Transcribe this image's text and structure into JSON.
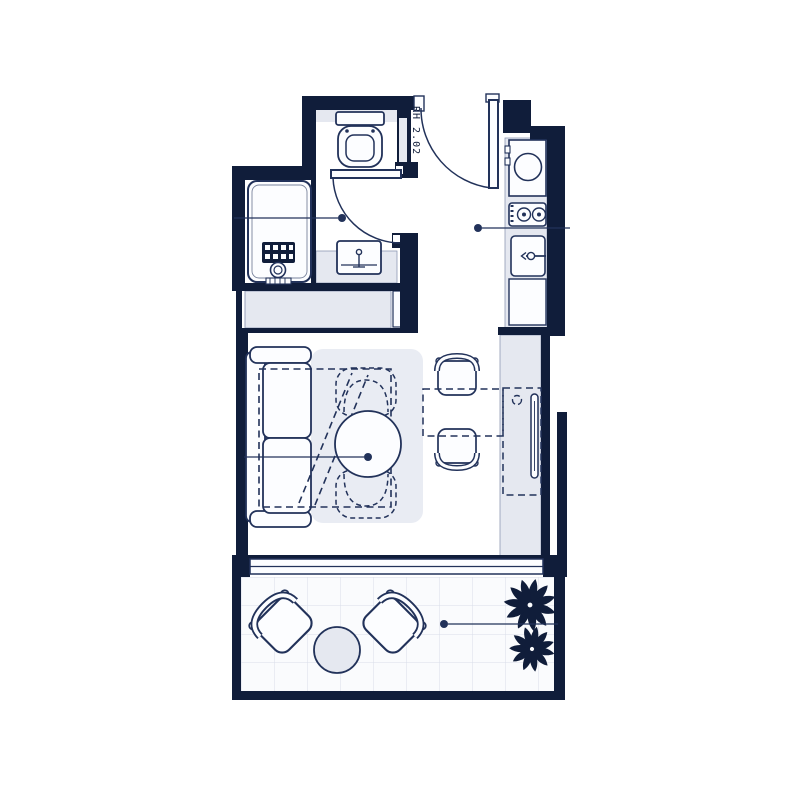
{
  "plan": {
    "unit_label": "RH 2.02"
  },
  "colors": {
    "wall": "#101d3a",
    "line": "#22325a",
    "fill_light": "#e5e8f0",
    "fill_white": "#fcfdff",
    "grid": "#d9dee9",
    "background": "#ffffff"
  },
  "symbols": [
    "entry-door",
    "bathroom-door",
    "door-swing-arc",
    "toilet",
    "vanity-sink",
    "washing-machine",
    "wardrobe",
    "kitchen-appliance",
    "cooktop",
    "kitchen-sink",
    "kitchen-cabinet",
    "sofa",
    "rug",
    "murphy-bed-outline",
    "round-table",
    "dashed-armchair",
    "dining-chair",
    "fold-out-table",
    "tv-panel",
    "counter-column",
    "balcony-chair",
    "balcony-table",
    "plant",
    "leader-dot"
  ]
}
